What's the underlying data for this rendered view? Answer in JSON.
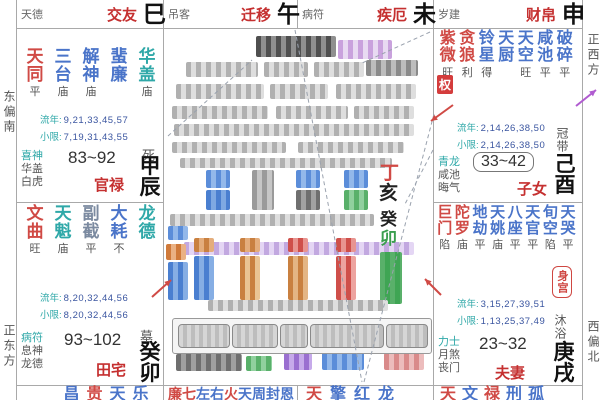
{
  "palette": {
    "red": "#d04a45",
    "blue": "#4a74c9",
    "teal": "#2fa8a8",
    "slate": "#7b8aa0",
    "ink": "#222222",
    "green": "#3a9e4e",
    "navy": "#3a55a0",
    "pname": "#c53030"
  },
  "labels": {
    "liunian": "流年:",
    "xiaoxian": "小限:"
  },
  "compass": {
    "left_top": "东偏南",
    "left_bottom": "正东方",
    "right_top": "正西方",
    "right_bottom": "西偏北"
  },
  "top_row": [
    {
      "shensha": "天德",
      "palace": "交友",
      "branch": "巳"
    },
    {
      "shensha": "吊客",
      "palace": "迁移",
      "branch": "午"
    },
    {
      "shensha": "病符",
      "palace": "疾厄",
      "branch": "未"
    },
    {
      "shensha": "岁建",
      "palace": "财帛",
      "branch": "申"
    }
  ],
  "palaces": {
    "chen": {
      "stars": [
        {
          "n": "天同",
          "c": "red",
          "b": "平"
        },
        {
          "n": "三台",
          "c": "blue",
          "b": "庙"
        },
        {
          "n": "解神",
          "c": "blue",
          "b": "庙"
        },
        {
          "n": "蜚廉",
          "c": "blue",
          "b": ""
        },
        {
          "n": "华盖",
          "c": "teal",
          "b": "庙"
        }
      ],
      "liunian": "9,21,33,45,57",
      "xiaoxian": "7,19,31,43,55",
      "shensha": [
        "喜神",
        "华盖",
        "白虎"
      ],
      "range": "83~92",
      "palace": "官禄",
      "stem_branch": "甲辰",
      "changsheng": "死"
    },
    "mao": {
      "stars": [
        {
          "n": "文曲",
          "c": "red",
          "b": "旺"
        },
        {
          "n": "天魁",
          "c": "teal",
          "b": "庙"
        },
        {
          "n": "副截",
          "c": "slate",
          "b": "平"
        },
        {
          "n": "大耗",
          "c": "blue",
          "b": "不"
        },
        {
          "n": "龙德",
          "c": "teal",
          "b": ""
        }
      ],
      "liunian": "8,20,32,44,56",
      "xiaoxian": "8,20,32,44,56",
      "shensha": [
        "病符",
        "息神",
        "龙德"
      ],
      "range": "93~102",
      "palace": "田宅",
      "stem_branch": "癸卯",
      "changsheng": "墓"
    },
    "you": {
      "stars": [
        {
          "n": "紫微",
          "c": "red",
          "b": "旺"
        },
        {
          "n": "贪狼",
          "c": "red",
          "b": "利"
        },
        {
          "n": "铃星",
          "c": "blue",
          "b": "得"
        },
        {
          "n": "天厨",
          "c": "blue",
          "b": ""
        },
        {
          "n": "天空",
          "c": "blue",
          "b": "旺"
        },
        {
          "n": "咸池",
          "c": "blue",
          "b": "平"
        },
        {
          "n": "破碎",
          "c": "blue",
          "b": "平"
        }
      ],
      "hua": "权",
      "liunian": "2,14,26,38,50",
      "xiaoxian": "2,14,26,38,50",
      "shensha": [
        "青龙",
        "咸池",
        "晦气"
      ],
      "range": "33~42",
      "palace": "子女",
      "stem_branch": "己酉",
      "changsheng": "冠带"
    },
    "xu": {
      "stars": [
        {
          "n": "巨门",
          "c": "red",
          "b": "陷"
        },
        {
          "n": "陀罗",
          "c": "red",
          "b": "庙"
        },
        {
          "n": "地劫",
          "c": "blue",
          "b": "平"
        },
        {
          "n": "天姚",
          "c": "blue",
          "b": "庙"
        },
        {
          "n": "八座",
          "c": "blue",
          "b": "平"
        },
        {
          "n": "天官",
          "c": "blue",
          "b": "平"
        },
        {
          "n": "旬空",
          "c": "blue",
          "b": "陷"
        },
        {
          "n": "天哭",
          "c": "blue",
          "b": "平"
        }
      ],
      "liunian": "3,15,27,39,51",
      "xiaoxian": "1,13,25,37,49",
      "shensha": [
        "力士",
        "月煞",
        "丧门"
      ],
      "range": "23~32",
      "palace": "夫妻",
      "stem_branch": "庚戌",
      "changsheng": "沐浴",
      "body_badge": "身宫"
    }
  },
  "bottom_row": [
    {
      "left": 44,
      "cw": 23,
      "fs": 16,
      "chars": [
        {
          "ch": "昌",
          "c": "blue"
        },
        {
          "ch": "贵",
          "c": "red"
        },
        {
          "ch": "天",
          "c": "blue"
        },
        {
          "ch": "乐",
          "c": "blue"
        }
      ]
    },
    {
      "left": 5,
      "cw": 14,
      "fs": 14,
      "chars": [
        {
          "ch": "廉",
          "c": "red"
        },
        {
          "ch": "七",
          "c": "red"
        },
        {
          "ch": "左",
          "c": "blue"
        },
        {
          "ch": "右",
          "c": "blue"
        },
        {
          "ch": "火",
          "c": "red"
        },
        {
          "ch": "天",
          "c": "blue"
        },
        {
          "ch": "周",
          "c": "blue"
        },
        {
          "ch": "封",
          "c": "blue"
        },
        {
          "ch": "恩",
          "c": "blue"
        }
      ]
    },
    {
      "left": 5,
      "cw": 24,
      "fs": 16,
      "chars": [
        {
          "ch": "天",
          "c": "red"
        },
        {
          "ch": "擎",
          "c": "blue"
        },
        {
          "ch": "红",
          "c": "blue"
        },
        {
          "ch": "龙",
          "c": "blue"
        }
      ]
    },
    {
      "left": 4,
      "cw": 22,
      "fs": 16,
      "chars": [
        {
          "ch": "天",
          "c": "red"
        },
        {
          "ch": "文",
          "c": "blue"
        },
        {
          "ch": "禄",
          "c": "red"
        },
        {
          "ch": "刑",
          "c": "blue"
        },
        {
          "ch": "孤",
          "c": "blue"
        }
      ]
    }
  ],
  "center": {
    "visible_chars": [
      {
        "ch": "丁",
        "c": "red",
        "x": 380,
        "y": 164,
        "fs": 19
      },
      {
        "ch": "亥",
        "c": "ink",
        "x": 379,
        "y": 184,
        "fs": 19
      },
      {
        "ch": "癸",
        "c": "ink",
        "x": 380,
        "y": 211,
        "fs": 17
      },
      {
        "ch": "卯",
        "c": "green",
        "x": 380,
        "y": 230,
        "fs": 17
      }
    ],
    "redacted": [
      {
        "x": 256,
        "y": 36,
        "w": 80,
        "h": 21,
        "a": "#4f4f4f",
        "b": "#8f8f8f"
      },
      {
        "x": 338,
        "y": 40,
        "w": 54,
        "h": 19,
        "a": "#c9a2dd",
        "b": "#e8daf2"
      },
      {
        "x": 186,
        "y": 62,
        "w": 72,
        "h": 15
      },
      {
        "x": 264,
        "y": 62,
        "w": 44,
        "h": 15
      },
      {
        "x": 314,
        "y": 62,
        "w": 50,
        "h": 15
      },
      {
        "x": 366,
        "y": 60,
        "w": 52,
        "h": 16,
        "a": "#8a8a8a",
        "b": "#bdbdbd"
      },
      {
        "x": 176,
        "y": 84,
        "w": 88,
        "h": 15
      },
      {
        "x": 270,
        "y": 84,
        "w": 58,
        "h": 15
      },
      {
        "x": 336,
        "y": 84,
        "w": 80,
        "h": 15
      },
      {
        "x": 172,
        "y": 106,
        "w": 96,
        "h": 13
      },
      {
        "x": 276,
        "y": 106,
        "w": 72,
        "h": 13
      },
      {
        "x": 354,
        "y": 106,
        "w": 60,
        "h": 13
      },
      {
        "x": 174,
        "y": 124,
        "w": 240,
        "h": 12
      },
      {
        "x": 172,
        "y": 142,
        "w": 114,
        "h": 11
      },
      {
        "x": 298,
        "y": 142,
        "w": 106,
        "h": 11
      },
      {
        "x": 180,
        "y": 158,
        "w": 212,
        "h": 10
      },
      {
        "x": 206,
        "y": 170,
        "w": 24,
        "h": 18,
        "a": "#5b8dd9",
        "b": "#93b8ea"
      },
      {
        "x": 206,
        "y": 190,
        "w": 24,
        "h": 20,
        "a": "#4a7fd0",
        "b": "#7fa9e2"
      },
      {
        "x": 252,
        "y": 170,
        "w": 22,
        "h": 40,
        "a": "#9a9a9a",
        "b": "#c6c6c6"
      },
      {
        "x": 296,
        "y": 170,
        "w": 24,
        "h": 18,
        "a": "#5b8dd9",
        "b": "#93b8ea"
      },
      {
        "x": 296,
        "y": 190,
        "w": 24,
        "h": 20,
        "a": "#6f6f6f",
        "b": "#a2a2a2"
      },
      {
        "x": 344,
        "y": 170,
        "w": 24,
        "h": 18,
        "a": "#5b8dd9",
        "b": "#93b8ea"
      },
      {
        "x": 344,
        "y": 190,
        "w": 24,
        "h": 20,
        "a": "#59b06a",
        "b": "#90d09e"
      },
      {
        "x": 170,
        "y": 214,
        "w": 204,
        "h": 12
      },
      {
        "x": 184,
        "y": 242,
        "w": 230,
        "h": 13,
        "a": "#c2a8e0",
        "b": "#e4d6f4"
      },
      {
        "x": 168,
        "y": 226,
        "w": 20,
        "h": 14,
        "a": "#5b8dd9",
        "b": "#93b8ea"
      },
      {
        "x": 166,
        "y": 244,
        "w": 20,
        "h": 16,
        "a": "#d07a3a",
        "b": "#eab184"
      },
      {
        "x": 168,
        "y": 262,
        "w": 20,
        "h": 38,
        "a": "#4a7fd0",
        "b": "#86aee4"
      },
      {
        "x": 194,
        "y": 238,
        "w": 20,
        "h": 14,
        "a": "#c98040",
        "b": "#e4ad7c"
      },
      {
        "x": 194,
        "y": 256,
        "w": 20,
        "h": 44,
        "a": "#4a7fd0",
        "b": "#86aee4"
      },
      {
        "x": 240,
        "y": 238,
        "w": 20,
        "h": 14,
        "a": "#c98040",
        "b": "#e4ad7c"
      },
      {
        "x": 240,
        "y": 256,
        "w": 20,
        "h": 44,
        "a": "#c98040",
        "b": "#eac494"
      },
      {
        "x": 288,
        "y": 238,
        "w": 20,
        "h": 14,
        "a": "#cf4f4a",
        "b": "#e89490"
      },
      {
        "x": 288,
        "y": 256,
        "w": 20,
        "h": 44,
        "a": "#c98040",
        "b": "#e4b584"
      },
      {
        "x": 336,
        "y": 238,
        "w": 20,
        "h": 14,
        "a": "#cf4f4a",
        "b": "#e89490"
      },
      {
        "x": 336,
        "y": 256,
        "w": 20,
        "h": 44,
        "a": "#cf4f4a",
        "b": "#eda39f"
      },
      {
        "x": 380,
        "y": 252,
        "w": 22,
        "h": 52,
        "a": "#59b06a",
        "b": "#3fa554"
      },
      {
        "x": 208,
        "y": 300,
        "w": 180,
        "h": 11
      },
      {
        "x": 176,
        "y": 354,
        "w": 66,
        "h": 17,
        "a": "#6f6f6f",
        "b": "#a0a0a0"
      },
      {
        "x": 246,
        "y": 356,
        "w": 26,
        "h": 15,
        "a": "#59b06a",
        "b": "#90d09e"
      },
      {
        "x": 284,
        "y": 353,
        "w": 28,
        "h": 17,
        "a": "#9a6fd0",
        "b": "#c6aaea"
      },
      {
        "x": 322,
        "y": 351,
        "w": 42,
        "h": 19,
        "a": "#5b8dd9",
        "b": "#93b8ea"
      },
      {
        "x": 384,
        "y": 353,
        "w": 40,
        "h": 17,
        "a": "#d98a8a",
        "b": "#ecbcbc"
      }
    ],
    "toolbar": {
      "buttons": [
        {
          "x": 5,
          "w": 50
        },
        {
          "x": 59,
          "w": 44
        },
        {
          "x": 107,
          "w": 26
        },
        {
          "x": 137,
          "w": 72
        },
        {
          "x": 213,
          "w": 40
        }
      ]
    }
  },
  "overlay": {
    "dashed": [
      [
        295,
        30,
        362,
        382
      ],
      [
        434,
        114,
        364,
        382
      ],
      [
        168,
        136,
        252,
        60
      ],
      [
        430,
        32,
        360,
        64
      ],
      [
        433,
        150,
        404,
        206
      ]
    ],
    "arrows": [
      {
        "x1": 152,
        "y1": 297,
        "x2": 171,
        "y2": 280,
        "c": "#d04a45"
      },
      {
        "x1": 441,
        "y1": 295,
        "x2": 425,
        "y2": 279,
        "c": "#d04a45"
      },
      {
        "x1": 453,
        "y1": 105,
        "x2": 431,
        "y2": 121,
        "c": "#d04a45"
      },
      {
        "x1": 576,
        "y1": 106,
        "x2": 596,
        "y2": 90,
        "c": "#b05bd0"
      }
    ]
  }
}
